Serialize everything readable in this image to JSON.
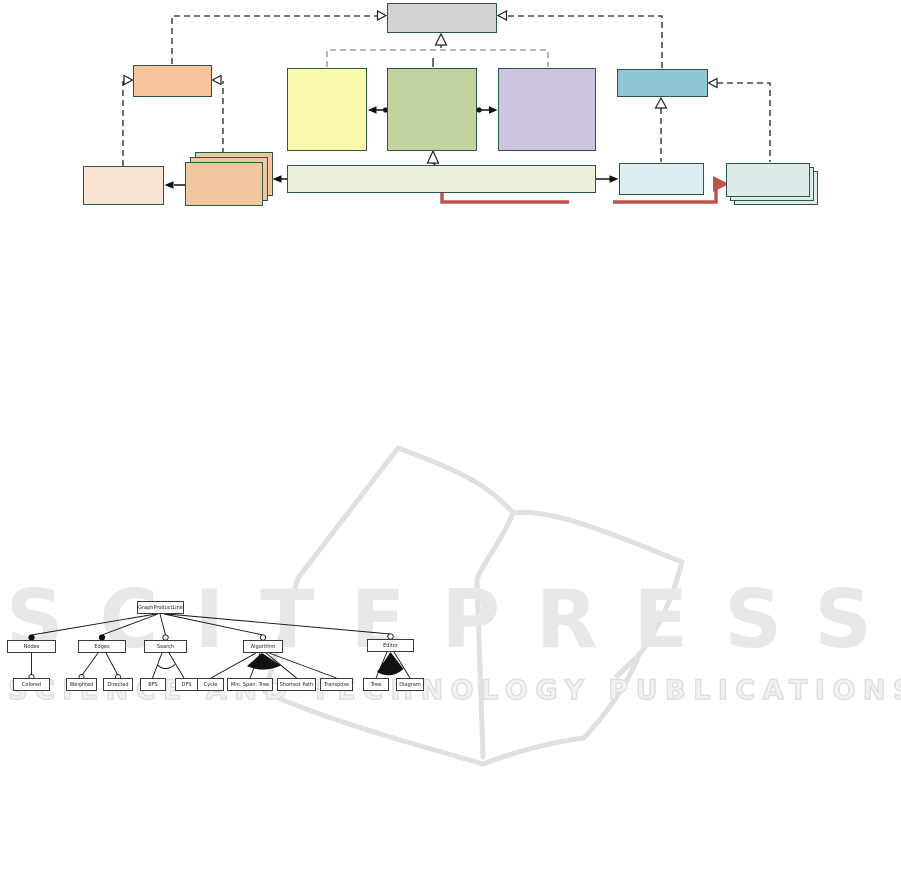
{
  "watermark": {
    "line1": "SCITEPRESS",
    "line2": "SCIENCE AND TECHNOLOGY PUBLICATIONS",
    "text_color": "#e8e8e8",
    "book_stroke_color": "#e0e0e0"
  },
  "class_diagram": {
    "boxes": [
      {
        "id": "top-gray-box",
        "color": "#d3d3d3"
      },
      {
        "id": "orange-box",
        "color": "#f7c398"
      },
      {
        "id": "yellow-box",
        "color": "#fafaac"
      },
      {
        "id": "olive-box",
        "color": "#c2d3a0"
      },
      {
        "id": "purple-box",
        "color": "#cdc5df"
      },
      {
        "id": "teal-box",
        "color": "#8ec6d4"
      },
      {
        "id": "peach-box",
        "color": "#f9e3d3"
      },
      {
        "id": "stacked-orange-boxes",
        "color": "#f2c69e"
      },
      {
        "id": "wide-pale-green-box",
        "color": "#eaf0dc"
      },
      {
        "id": "light-blue-box",
        "color": "#ddedf0"
      },
      {
        "id": "stacked-blue-boxes",
        "color": "#ddeceb"
      }
    ],
    "border_color": "#2a5747",
    "red_arrow_color": "#c0514c",
    "dashed_line_color": "#222222",
    "bracket_line_color": "#8f8f8f"
  },
  "feature_model": {
    "root": {
      "label": "GraphProductLine"
    },
    "level1": [
      {
        "label": "Nodes",
        "relation": "mandatory",
        "group": "none"
      },
      {
        "label": "Edges",
        "relation": "mandatory",
        "group": "none"
      },
      {
        "label": "Search",
        "relation": "optional",
        "group": "alternative"
      },
      {
        "label": "Algorithm",
        "relation": "optional",
        "group": "or"
      },
      {
        "label": "Editor",
        "relation": "optional",
        "group": "or"
      }
    ],
    "level2": [
      {
        "label": "Colored",
        "parent": "Nodes",
        "relation": "optional"
      },
      {
        "label": "Weighted",
        "parent": "Edges",
        "relation": "optional"
      },
      {
        "label": "Directed",
        "parent": "Edges",
        "relation": "optional"
      },
      {
        "label": "BFS",
        "parent": "Search",
        "relation": "grouped"
      },
      {
        "label": "DFS",
        "parent": "Search",
        "relation": "grouped"
      },
      {
        "label": "Cycle",
        "parent": "Algorithm",
        "relation": "grouped"
      },
      {
        "label": "Min. Span. Tree",
        "parent": "Algorithm",
        "relation": "grouped"
      },
      {
        "label": "Shortest Path",
        "parent": "Algorithm",
        "relation": "grouped"
      },
      {
        "label": "Transpose",
        "parent": "Algorithm",
        "relation": "grouped"
      },
      {
        "label": "Tree",
        "parent": "Editor",
        "relation": "grouped"
      },
      {
        "label": "Diagram",
        "parent": "Editor",
        "relation": "grouped"
      }
    ]
  }
}
